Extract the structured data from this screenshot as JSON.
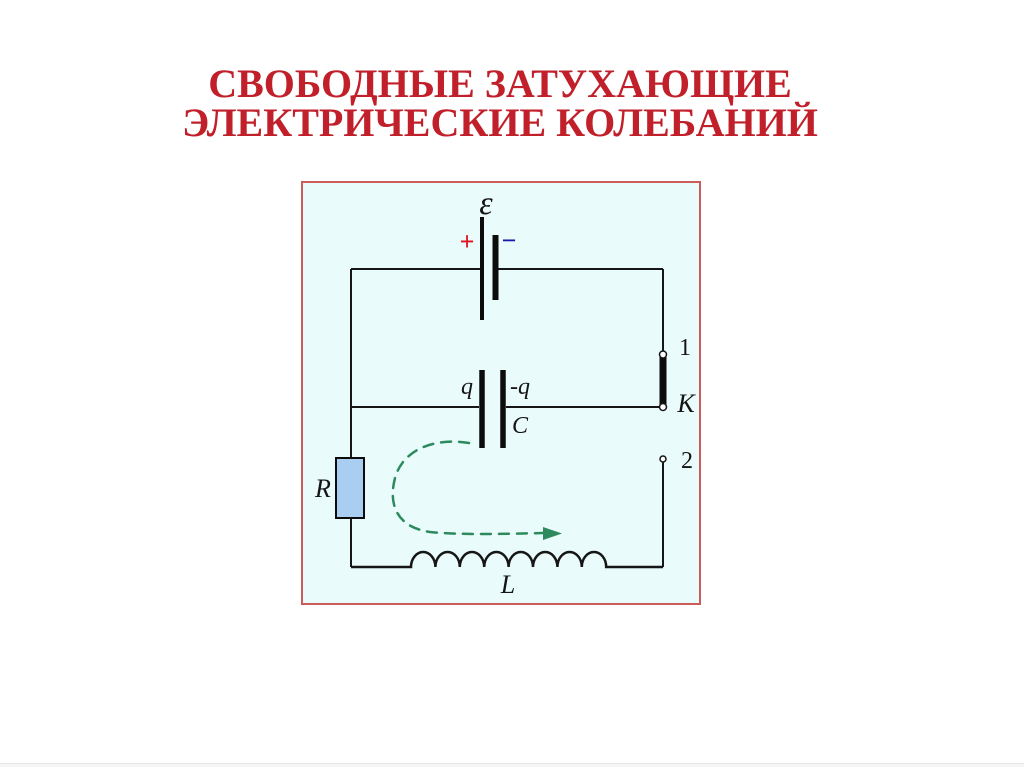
{
  "title": {
    "line1": "СВОБОДНЫЕ ЗАТУХАЮЩИЕ",
    "line2": "ЭЛЕКТРИЧЕСКИЕ КОЛЕБАНИЙ",
    "color": "#c1202b"
  },
  "circuit": {
    "labels": {
      "emf": "ε",
      "battery_plus": "+",
      "battery_minus": "−",
      "charge_positive": "q",
      "charge_negative": "-q",
      "capacitor": "C",
      "switch_contact_1": "1",
      "switch_contact_2": "2",
      "switch": "K",
      "resistor": "R",
      "inductor": "L"
    },
    "colors": {
      "box_border": "#cb5c5a",
      "box_background": "#e9fbfa",
      "wire": "#161616",
      "plus_sign": "#e51220",
      "minus_sign": "#1a17ae",
      "resistor_fill": "#aacdf2",
      "current_arrow": "#2c8a5e"
    }
  }
}
